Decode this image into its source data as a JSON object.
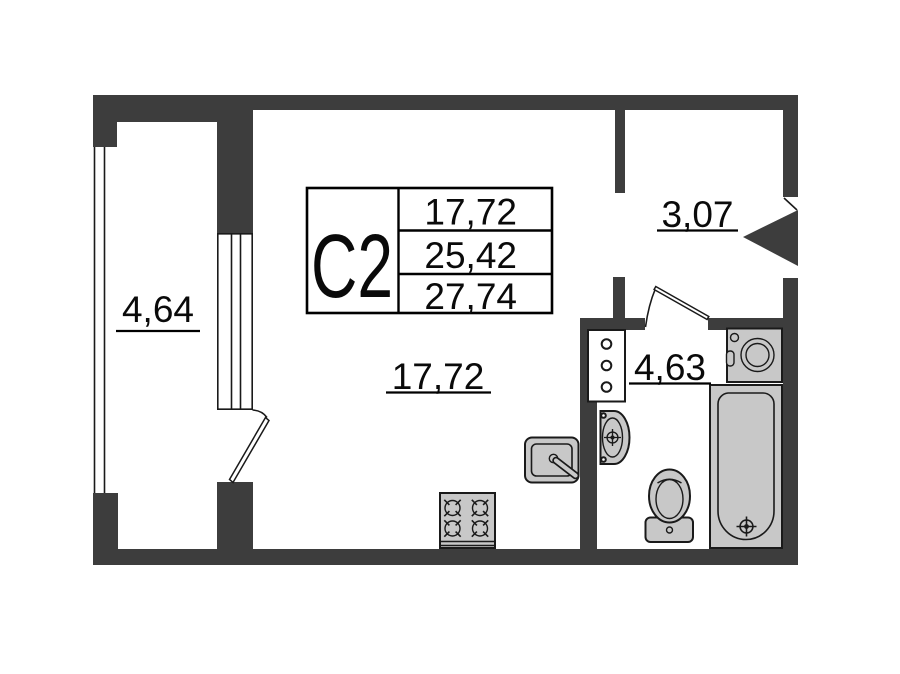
{
  "plan": {
    "unit": {
      "label": "С2"
    },
    "legend": {
      "values": [
        "17,72",
        "25,42",
        "27,74"
      ]
    },
    "rooms": [
      {
        "id": "balcony",
        "area": "4,64"
      },
      {
        "id": "main-room",
        "area": "17,72"
      },
      {
        "id": "hallway",
        "area": "3,07"
      },
      {
        "id": "bathroom",
        "area": "4,63"
      }
    ],
    "fixture_icons": [
      "stove-icon",
      "kitchen-sink-icon",
      "plumbing-riser-icon",
      "wash-basin-icon",
      "toilet-icon",
      "bathtub-icon",
      "washing-machine-icon",
      "entrance-door-icon",
      "balcony-door-icon",
      "bathroom-door-icon",
      "window-icon"
    ]
  },
  "colors": {
    "wall": "#3d3d3d",
    "fixture-fill": "#c8c8c8",
    "line": "#1a1a1a",
    "bg": "#ffffff"
  }
}
